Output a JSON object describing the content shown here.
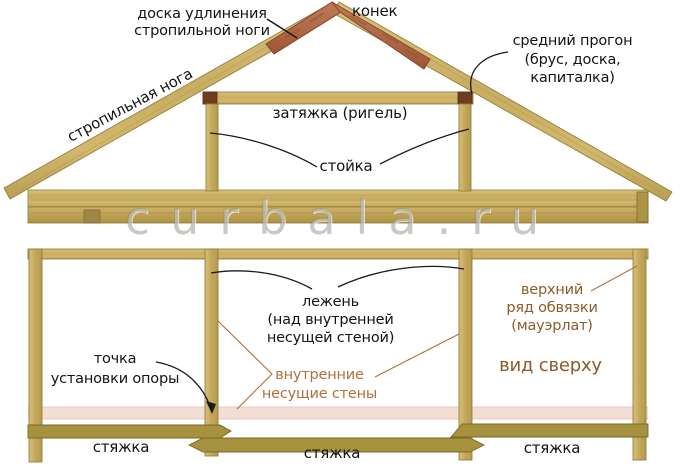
{
  "diagram_title": "roof truss structure scheme",
  "watermark": "curbala.ru",
  "truss_section": {
    "labels": {
      "extension_board": "доска удлинения\nстропильной ноги",
      "ridge": "конек",
      "middle_purlin": "средний прогон\n(брус, доска,\nкапиталка)",
      "rafter_leg": "стропильная нога",
      "tie_beam": "затяжка (ригель)",
      "post": "стойка"
    }
  },
  "plan_view": {
    "labels": {
      "sleeper": "лежень\n(над внутренней\nнесущей стеной)",
      "support_point": "точка\nустановки опоры",
      "internal_walls": "внутренние\nнесущие стены",
      "top_strapping": "верхний\nряд обвязки\n(мауэрлат)",
      "view_caption": "вид сверху",
      "tie_left": "стяжка",
      "tie_center": "стяжка",
      "tie_right": "стяжка"
    }
  },
  "colors": {
    "wood_light": "#d2b76e",
    "wood_mid": "#c6a95d",
    "wood_edge": "#93803f",
    "wood_dark_tie": "#a6913e",
    "extension_red": "#b26e4e",
    "extension_red_edge": "#8a4527",
    "joint_block_brown": "#6f3d1d",
    "wall_band_pink": "#f3ded6",
    "sienna_text": "#b0713c",
    "brown_text": "#8d5b27",
    "black_text": "#141414",
    "watermark_gray": "#8e8c82"
  }
}
